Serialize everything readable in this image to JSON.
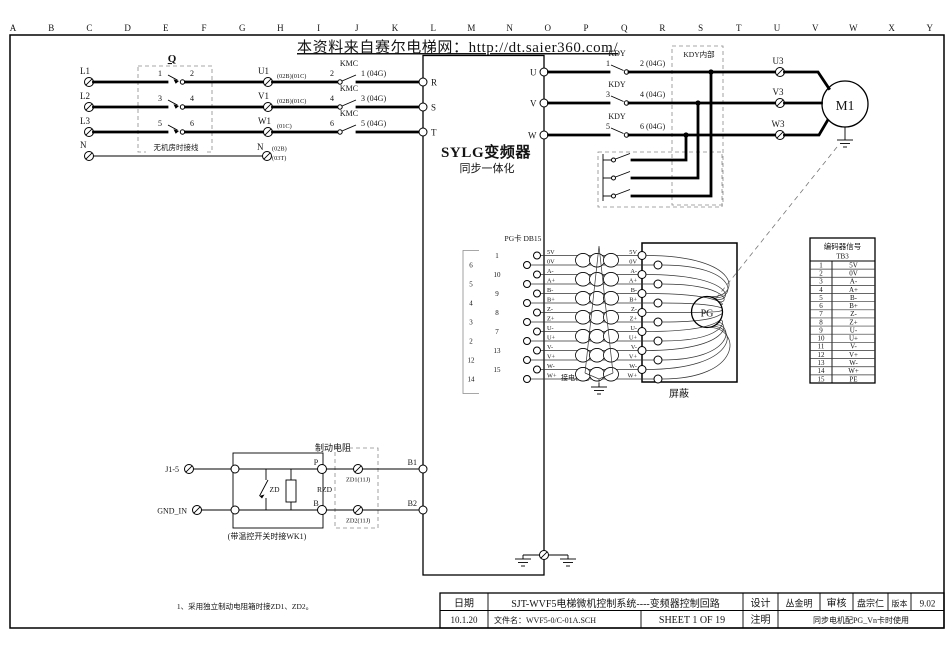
{
  "watermark": "本资料来自赛尔电梯网：http://dt.saier360.com/",
  "grid_letters": [
    "A",
    "B",
    "C",
    "D",
    "E",
    "F",
    "G",
    "H",
    "I",
    "J",
    "K",
    "L",
    "M",
    "N",
    "O",
    "P",
    "Q",
    "R",
    "S",
    "T",
    "U",
    "V",
    "W",
    "X",
    "Y"
  ],
  "power": {
    "breaker": "Q",
    "box_note": "无机房时接线",
    "rows": [
      {
        "src": "L1",
        "n1": "1",
        "n2": "2",
        "mid": "U1",
        "note": "(02B)(01C)",
        "relay": "KMC",
        "k1": "2",
        "k2": "1 (04G)",
        "term": "R"
      },
      {
        "src": "L2",
        "n1": "3",
        "n2": "4",
        "mid": "V1",
        "note": "(02B)(01C)",
        "relay": "KMC",
        "k1": "4",
        "k2": "3 (04G)",
        "term": "S"
      },
      {
        "src": "L3",
        "n1": "5",
        "n2": "6",
        "mid": "W1",
        "note": "(01C)",
        "relay": "KMC",
        "k1": "6",
        "k2": "5 (04G)",
        "term": "T"
      }
    ],
    "neutral": {
      "src": "N",
      "end": "N",
      "note_top": "(02B)",
      "note_bottom": "(03T)"
    }
  },
  "inverter": {
    "title": "SYLG变频器",
    "subtitle": "同步一体化"
  },
  "output": {
    "kdy_box": "KDY内部",
    "motor": "M1",
    "rows": [
      {
        "term": "U",
        "relay": "KDY",
        "k1": "1",
        "k2": "2 (04G)",
        "dest": "U3"
      },
      {
        "term": "V",
        "relay": "KDY",
        "k1": "3",
        "k2": "4 (04G)",
        "dest": "V3"
      },
      {
        "term": "W",
        "relay": "KDY",
        "k1": "5",
        "k2": "6 (04G)",
        "dest": "W3"
      }
    ]
  },
  "pg": {
    "header": "PG卡 DB15",
    "pins": [
      "1",
      "6",
      "10",
      "5",
      "9",
      "4",
      "8",
      "3",
      "7",
      "2",
      "13",
      "12",
      "15",
      "14"
    ],
    "signals": [
      "5V",
      "0V",
      "A-",
      "A+",
      "B-",
      "B+",
      "Z-",
      "Z+",
      "U-",
      "U+",
      "V-",
      "V+",
      "W-",
      "W+"
    ],
    "motor_gnd": "接电机地",
    "shield": "屏蔽",
    "encoder": "PG"
  },
  "tb3": {
    "title": "编码器信号",
    "name": "TB3",
    "rows": [
      [
        "1",
        "5V"
      ],
      [
        "2",
        "0V"
      ],
      [
        "3",
        "A-"
      ],
      [
        "4",
        "A+"
      ],
      [
        "5",
        "B-"
      ],
      [
        "6",
        "B+"
      ],
      [
        "7",
        "Z-"
      ],
      [
        "8",
        "Z+"
      ],
      [
        "9",
        "U-"
      ],
      [
        "10",
        "U+"
      ],
      [
        "11",
        "V-"
      ],
      [
        "12",
        "V+"
      ],
      [
        "13",
        "W-"
      ],
      [
        "14",
        "W+"
      ],
      [
        "15",
        "PE"
      ]
    ]
  },
  "brake": {
    "title": "制动电阻",
    "j": "J1-5",
    "gnd": "GND_IN",
    "zd": "ZD",
    "rzd": "RZD",
    "p": "P",
    "b": "B",
    "zd1": "ZD1(11J)",
    "zd2": "ZD2(11J)",
    "b1": "B1",
    "b2": "B2",
    "caption": "(带温控开关时接WK1)"
  },
  "note": "1、采用独立制动电阻箱时接ZD1、ZD2。",
  "title_block": {
    "date_label": "日期",
    "date_value": "10.1.20",
    "title": "SJT-WVF5电梯微机控制系统----变频器控制回路",
    "file_label": "文件名：WVF5-0/C-01A.SCH",
    "sheet": "SHEET 1 OF 19",
    "design_label": "设计",
    "designer": "丛金明",
    "review_label": "审核",
    "reviewer": "盘宗仁",
    "version_label": "版本",
    "version": "9.02",
    "remark_label": "注明",
    "remark": "同步电机配PG_Vn卡时使用"
  }
}
